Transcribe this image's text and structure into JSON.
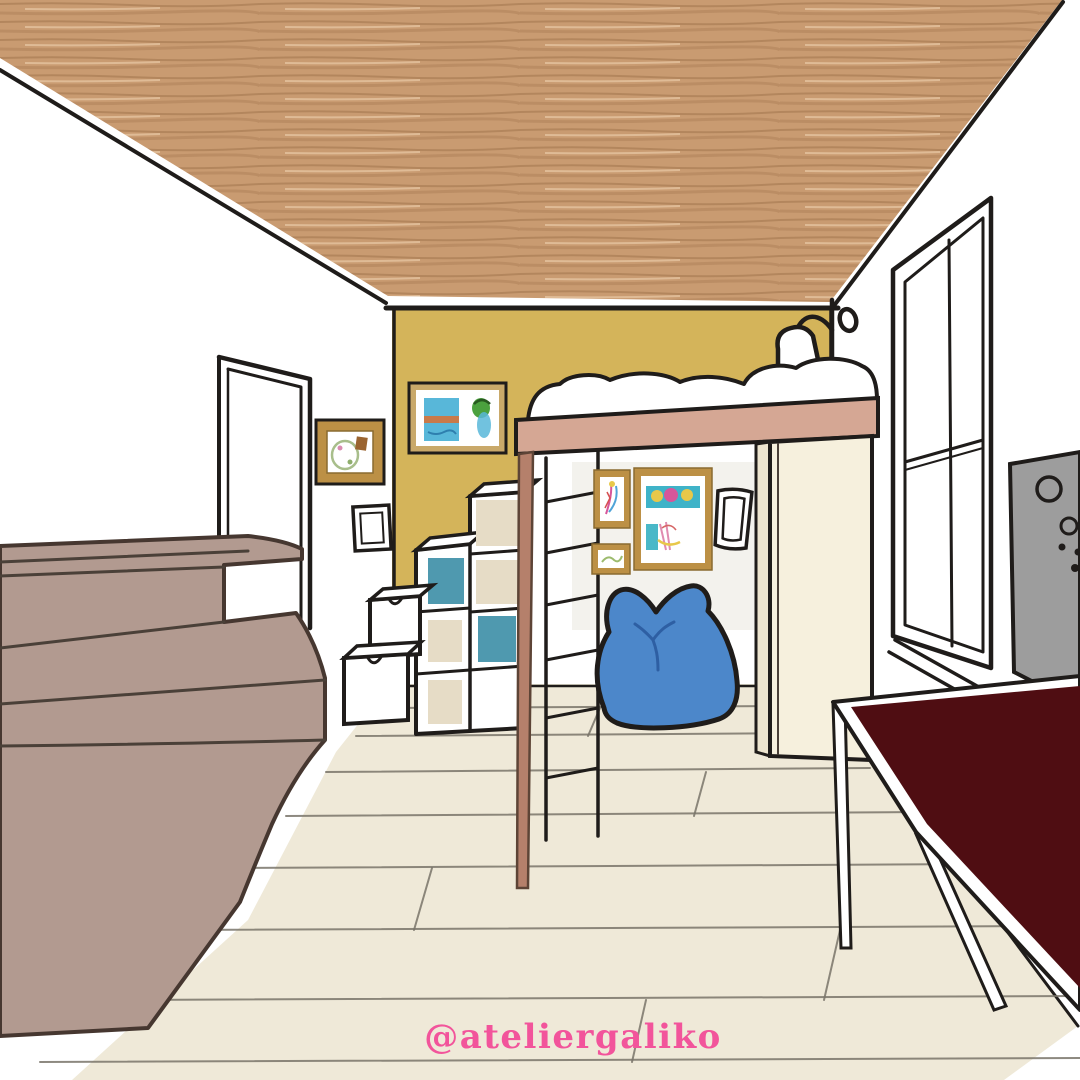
{
  "watermark": {
    "handle": "@ateliergaliko"
  },
  "palette": {
    "ceiling_wood": "#C99B71",
    "accent_wall_yellow": "#D4B45A",
    "wall_white": "#FFFFFF",
    "sketch_line": "#1F1C1A",
    "piano_mauve": "#B29A90",
    "loft_beam_pink": "#D5A794",
    "wood_post_brown": "#B5806B",
    "wardrobe_cream": "#F6F0DD",
    "wardrobe_side_cream": "#EDE5CF",
    "gallery_panel": "#F3F2ED",
    "floor_cream": "#EFE9D8",
    "beanbag_blue": "#4C87CA",
    "beanbag_crease_blue": "#2E5FA3",
    "storage_bin_teal": "#4F99AF",
    "cube_back_tan": "#E6DCC6",
    "table_top_maroon": "#4F0D12",
    "board_gray": "#9D9D9D",
    "frame_gold": "#BC9045",
    "frame_tan": "#C9A96A",
    "watermark_pink": "#F2549B"
  }
}
